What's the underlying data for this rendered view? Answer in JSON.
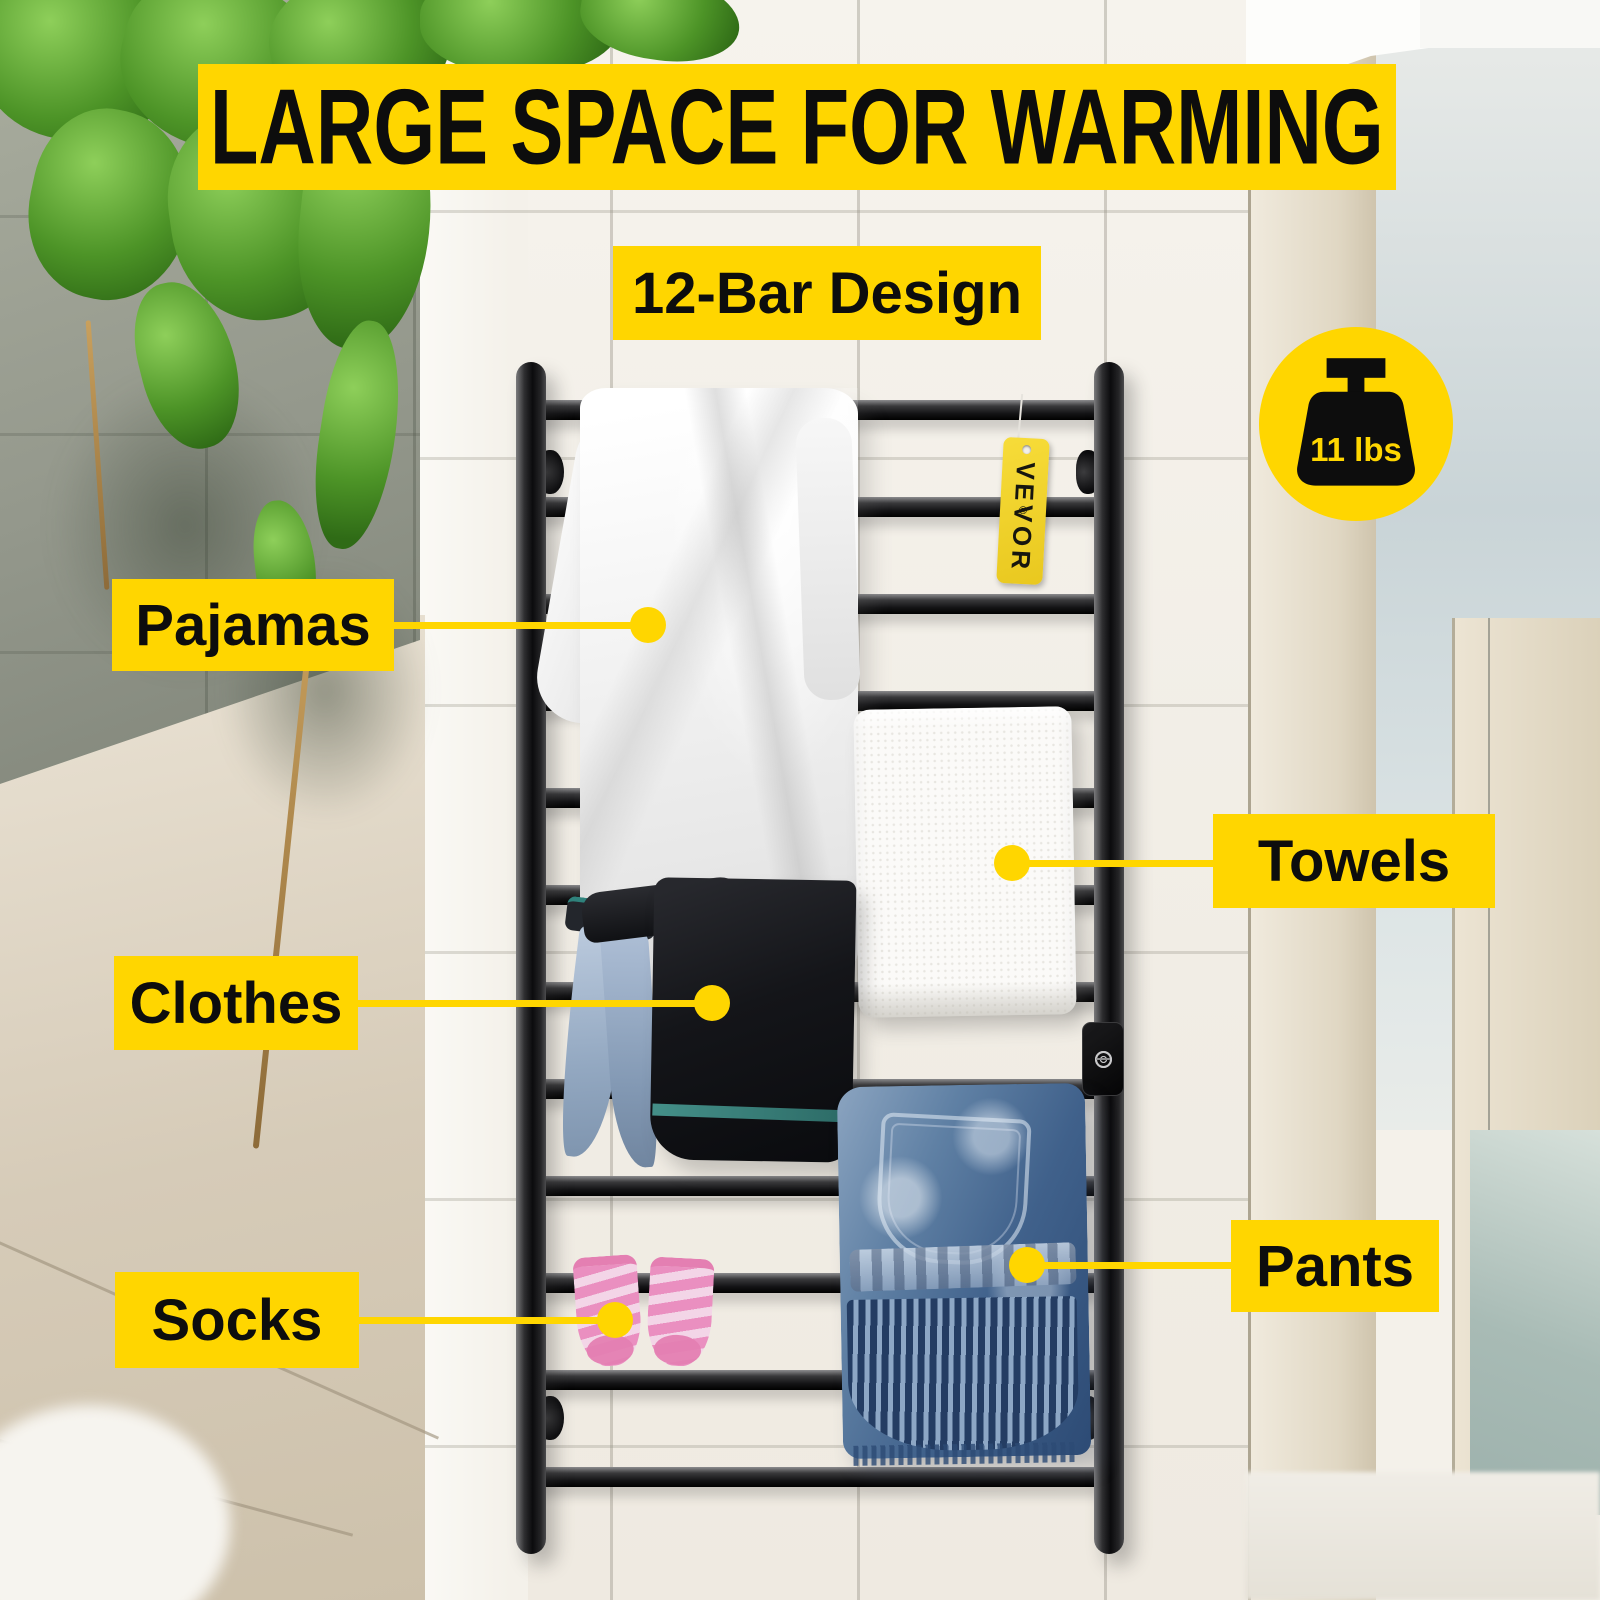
{
  "header": {
    "banner": "LARGE SPACE FOR WARMING",
    "design_badge": "12-Bar Design"
  },
  "weight_badge": {
    "label": "11 lbs",
    "icon": "weight-icon"
  },
  "brand_tag": {
    "label": "VEVOR",
    "mark": "®"
  },
  "callouts": [
    {
      "id": "pajamas",
      "label": "Pajamas"
    },
    {
      "id": "towels",
      "label": "Towels"
    },
    {
      "id": "clothes",
      "label": "Clothes"
    },
    {
      "id": "socks",
      "label": "Socks"
    },
    {
      "id": "pants",
      "label": "Pants"
    }
  ],
  "rack": {
    "bar_count": "12",
    "control_buttons": [
      "power-button-icon",
      "timer-button-icon"
    ]
  },
  "colors": {
    "accent": "#FFD600",
    "label_text": "#0D0D0D",
    "rack_black": "#151517"
  }
}
